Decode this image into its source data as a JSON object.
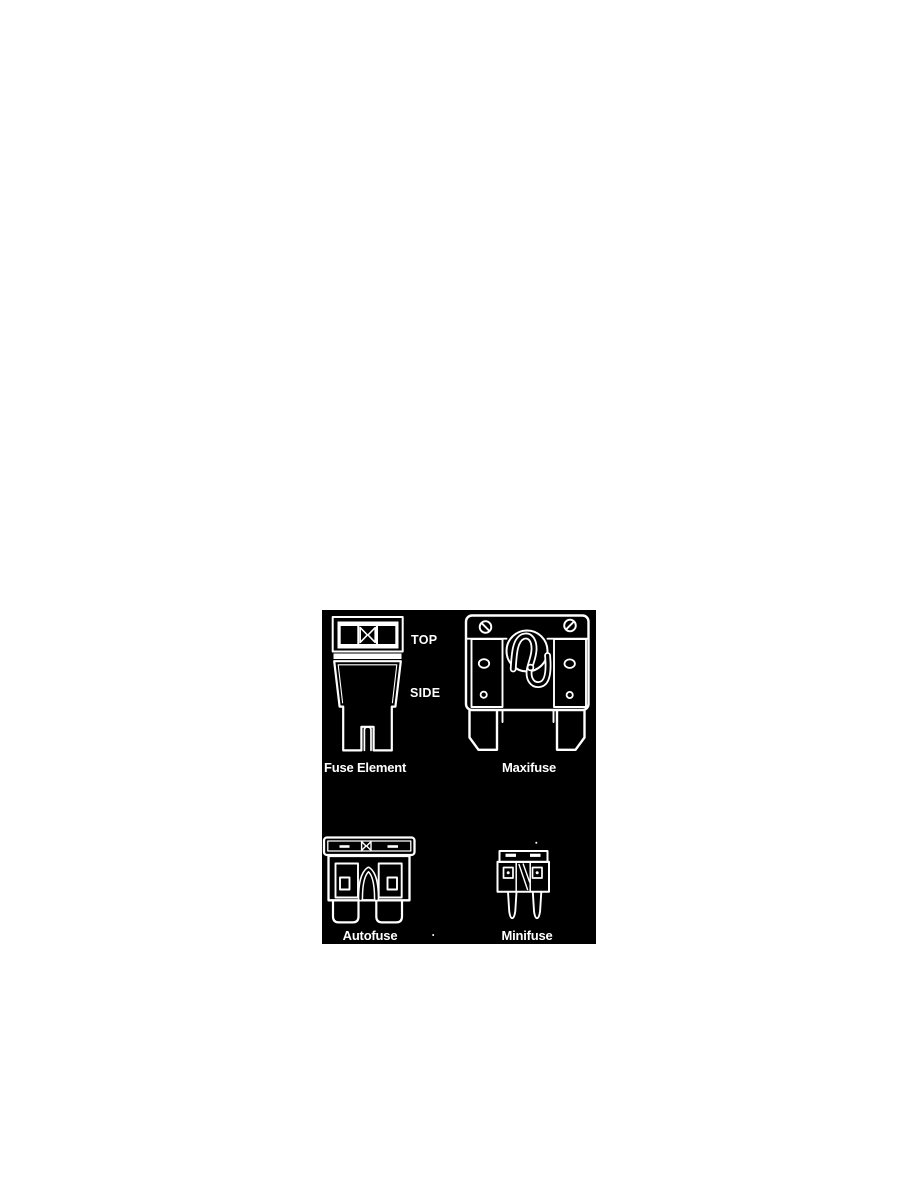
{
  "colors": {
    "page_background": "#ffffff",
    "figure_background": "#000000",
    "line_color": "#ffffff",
    "label_color": "#ffffff"
  },
  "figure": {
    "description_items": [
      "Fuse Element",
      "Maxifuse",
      "Autofuse",
      "Minifuse"
    ],
    "labels": {
      "top_view": "TOP",
      "side_view": "SIDE",
      "fuse_element": "Fuse Element",
      "maxifuse": "Maxifuse",
      "autofuse": "Autofuse",
      "minifuse": "Minifuse"
    }
  }
}
